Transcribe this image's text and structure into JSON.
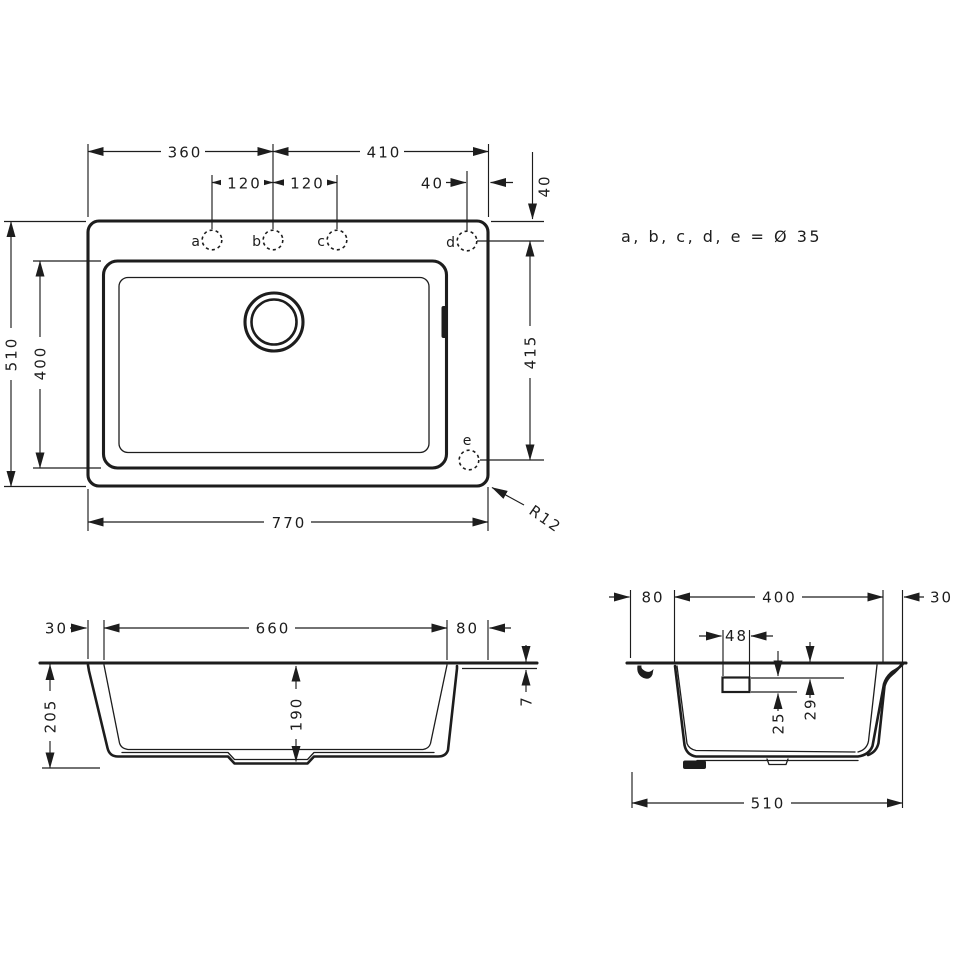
{
  "top": {
    "d360": "360",
    "d410": "410",
    "d120a": "120",
    "d120b": "120",
    "d40a": "40",
    "d40b": "40",
    "d415": "415",
    "d510": "510",
    "d400": "400",
    "d770": "770",
    "r12": "R12",
    "la": "a",
    "lb": "b",
    "lc": "c",
    "ld": "d",
    "le": "e",
    "note": "a, b, c, d, e = Ø 35"
  },
  "front": {
    "d30": "30",
    "d660": "660",
    "d80": "80",
    "d205": "205",
    "d190": "190",
    "d7": "7"
  },
  "side": {
    "d80": "80",
    "d400": "400",
    "d30": "30",
    "d48": "48",
    "d29": "29",
    "d25": "25",
    "d510": "510"
  }
}
